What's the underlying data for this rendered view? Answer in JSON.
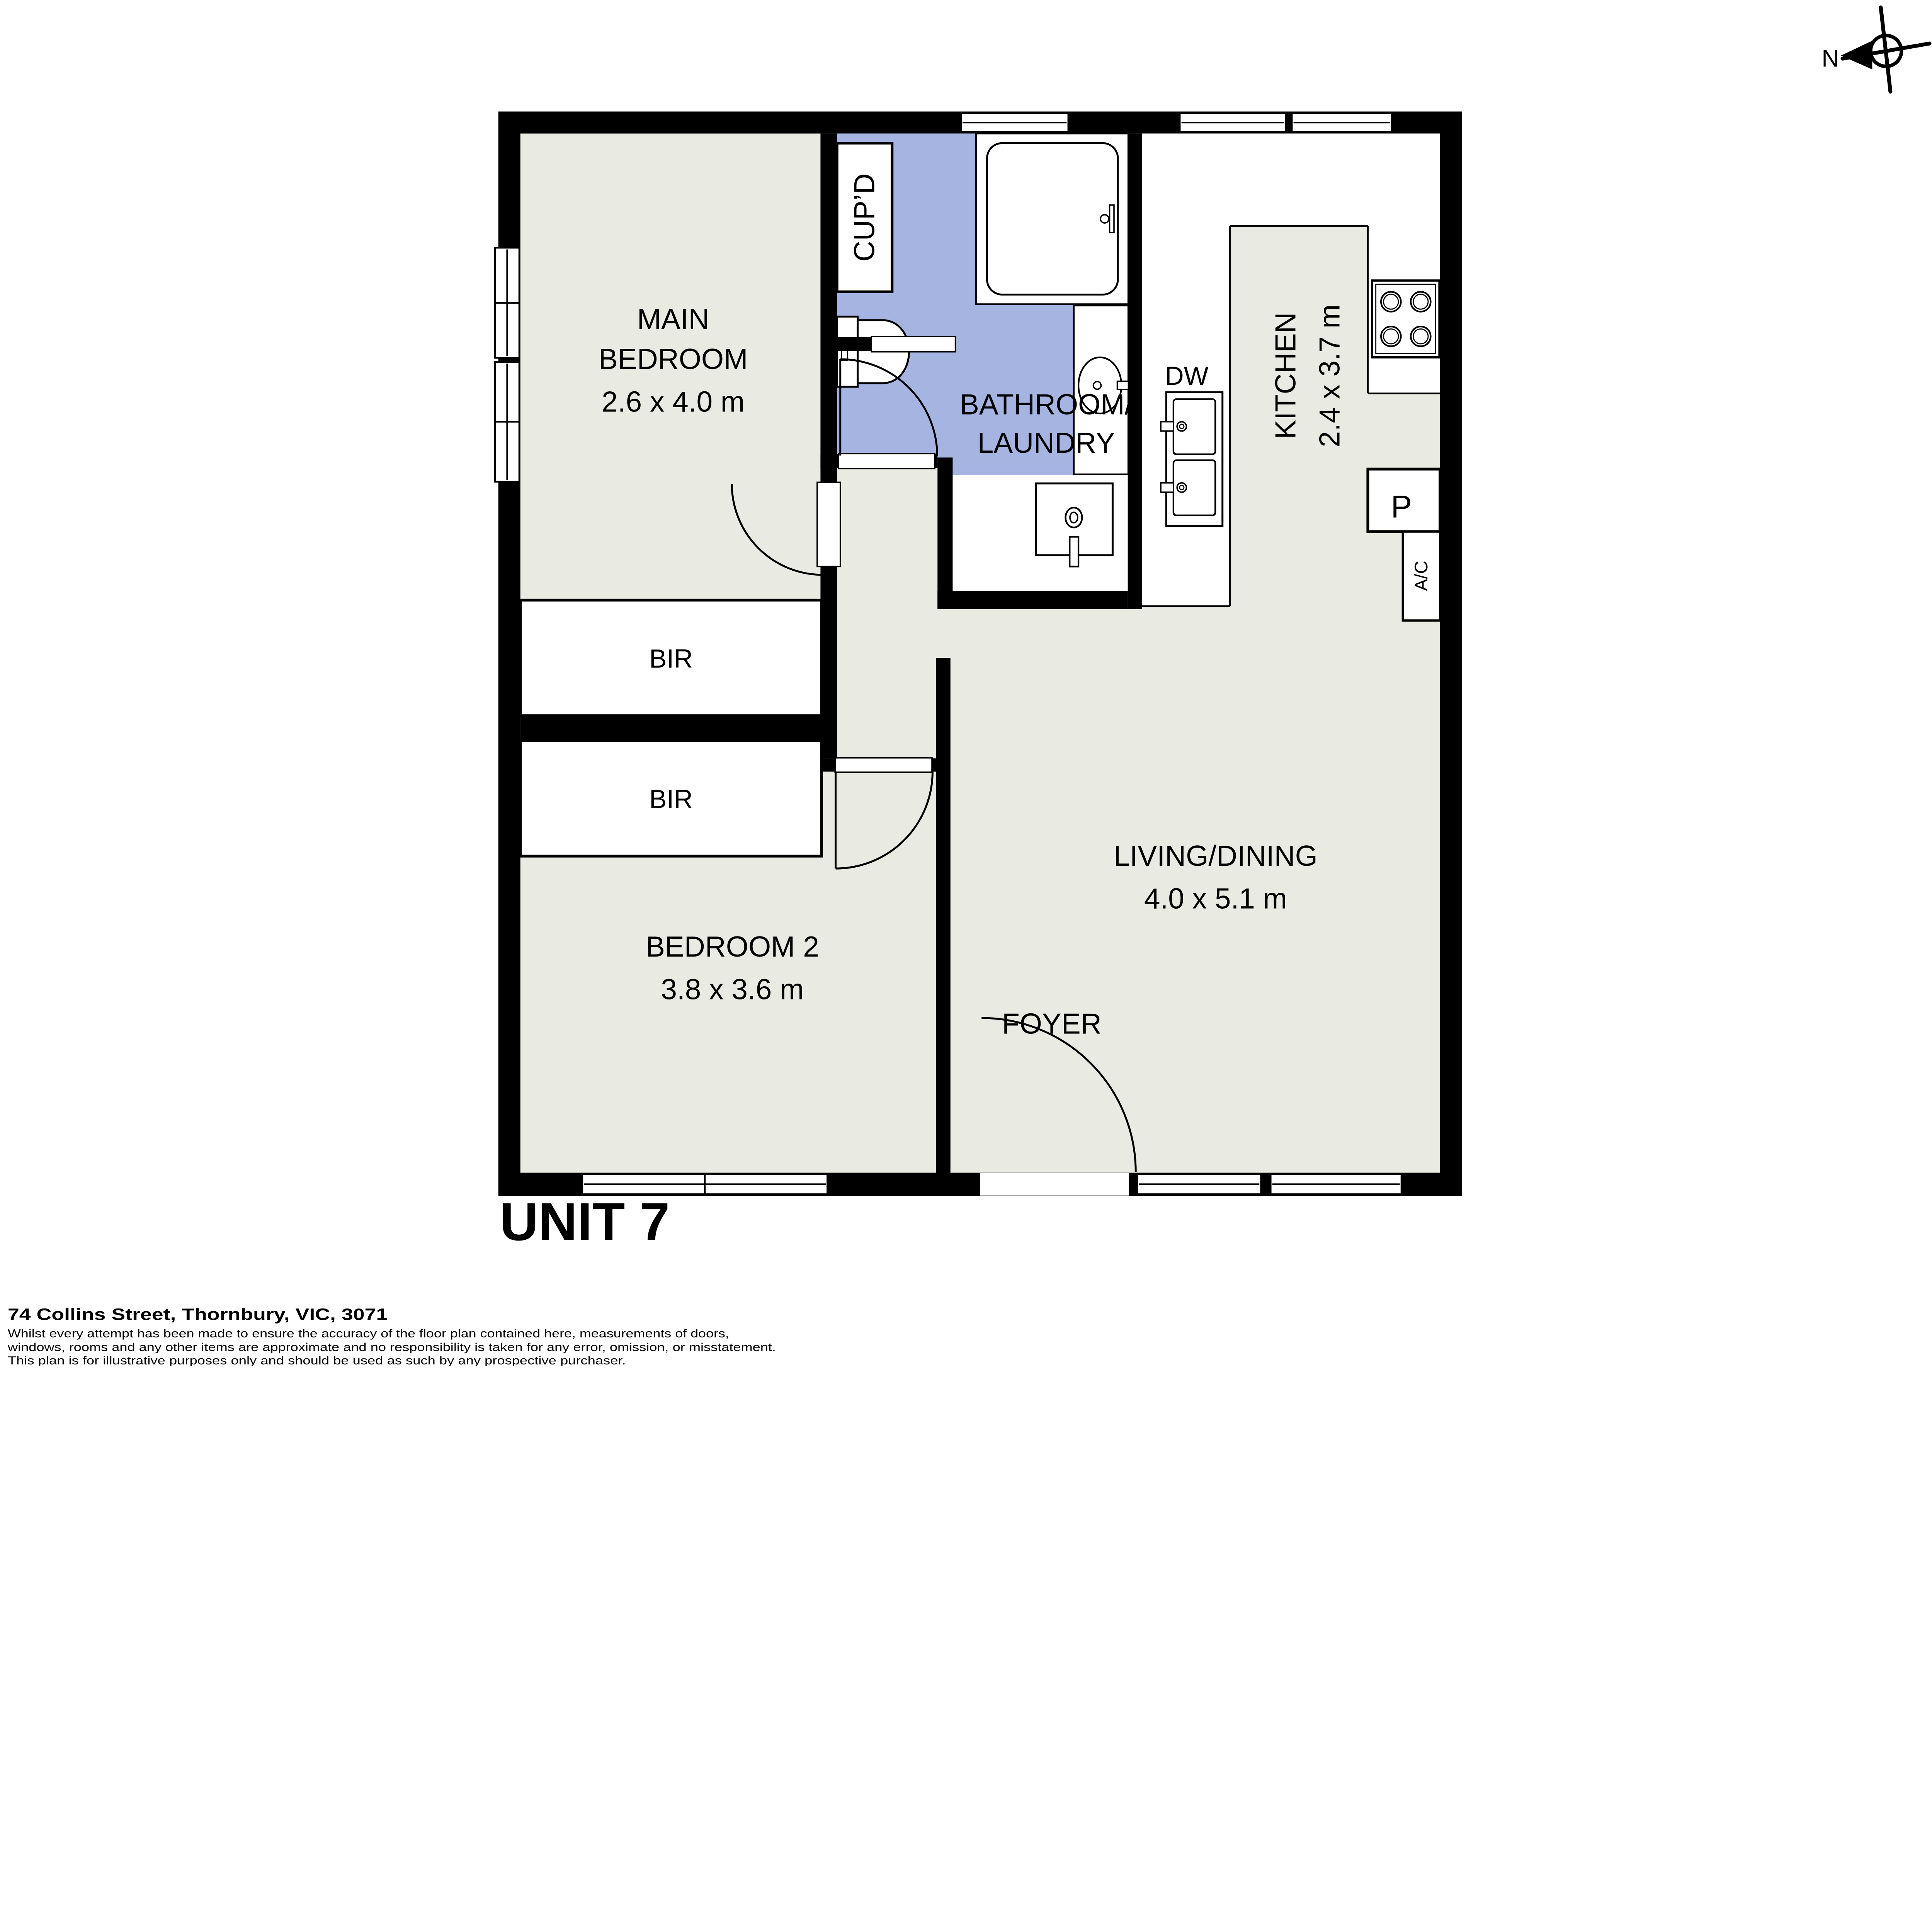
{
  "plan": {
    "unit_title": "UNIT 7",
    "address": "74 Collins Street, Thornbury, VIC, 3071",
    "disclaimer": {
      "line1": "Whilst every attempt has been made to ensure the accuracy of the floor plan contained here, measurements of doors,",
      "line2": "windows, rooms and any other items are approximate and no responsibility is taken for any error, omission, or misstatement.",
      "line3": "This plan is for illustrative purposes only and should be used as such by any prospective purchaser."
    },
    "compass": {
      "north": "N"
    },
    "rooms": {
      "main_bedroom": {
        "line1": "MAIN",
        "line2": "BEDROOM",
        "dims": "2.6 x 4.0 m"
      },
      "bedroom_2": {
        "name": "BEDROOM 2",
        "dims": "3.8 x 3.6 m"
      },
      "living_dining": {
        "name": "LIVING/DINING",
        "dims": "4.0 x 5.1 m"
      },
      "kitchen": {
        "name": "KITCHEN",
        "dims": "2.4 x 3.7 m"
      },
      "bathroom_laundry": {
        "line1": "BATHROOM/",
        "line2": "LAUNDRY"
      },
      "foyer": {
        "name": "FOYER"
      },
      "cupboard": {
        "name": "CUP’D"
      },
      "bir_main": {
        "name": "BIR"
      },
      "bir_second": {
        "name": "BIR"
      }
    },
    "features": {
      "dishwasher": "DW",
      "pantry": "P",
      "air_conditioner": "A/C"
    },
    "colors": {
      "wall": "#000000",
      "floor": "#e9eae1",
      "wet_area": "#a6b4e2",
      "fixture": "#ffffff"
    }
  }
}
